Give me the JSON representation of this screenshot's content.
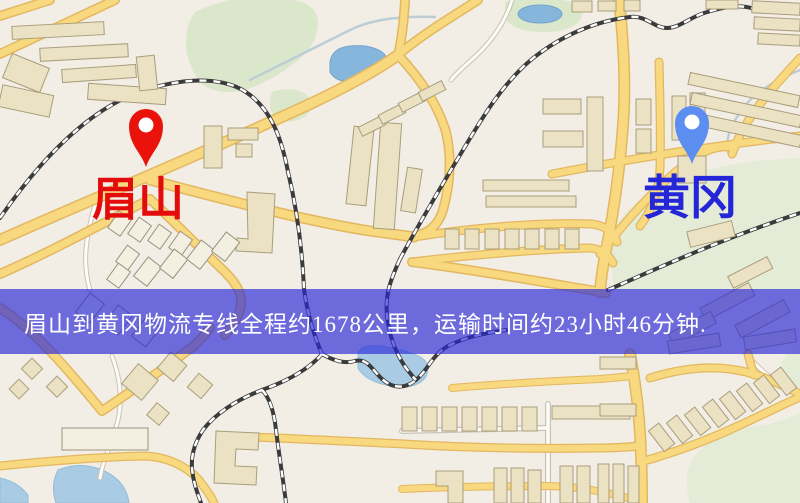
{
  "map": {
    "type": "street-map",
    "origin": {
      "label": "眉山",
      "marker": "red-location-pin"
    },
    "destination": {
      "label": "黄冈",
      "marker": "blue-location-pin"
    }
  },
  "banner": {
    "text": "眉山到黄冈物流专线全程约1678公里，运输时间约23小时46分钟.",
    "route_info": {
      "distance_text": "约1678公里",
      "duration_text": "约23小时46分钟"
    }
  },
  "colors": {
    "origin_pin": "#ea130b",
    "origin_label": "#e30b0b",
    "destination_pin": "#5b8ef0",
    "destination_label": "#2426d8",
    "banner_background": "rgba(40,40,215,0.66)",
    "banner_text": "#ffffff"
  }
}
